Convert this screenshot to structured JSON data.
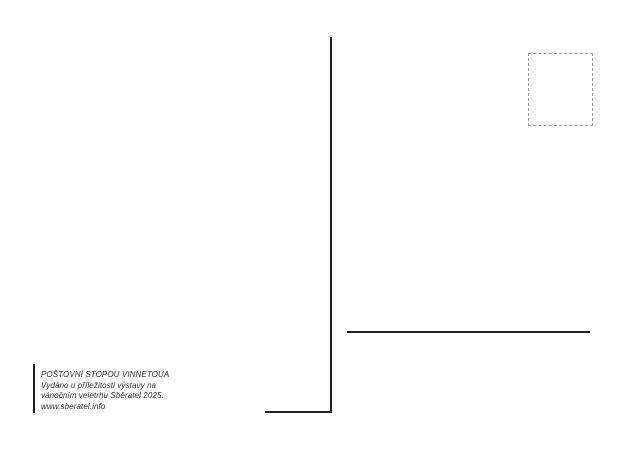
{
  "postcard": {
    "background_color": "#ffffff",
    "divider_color": "#222222",
    "stamp_border_color": "#999999"
  },
  "imprint": {
    "lines": [
      "POŠTOVNÍ STOPOU VINNETOUA",
      "Vydáno u příležitosti výstavy na",
      "vánočním veletrhu Sběratel 2025.",
      "www.sberatel.info"
    ]
  }
}
